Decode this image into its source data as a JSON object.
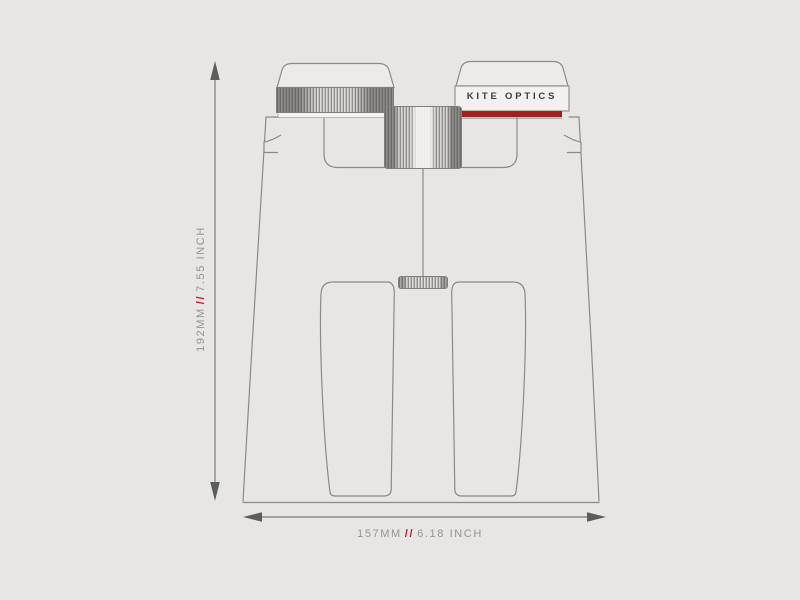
{
  "title": "Binoculars size diagram",
  "brand": {
    "label": "KITE OPTICS"
  },
  "dimensions": {
    "height": {
      "mm": "192MM",
      "separator": "//",
      "inch": "7.55 INCH"
    },
    "width": {
      "mm": "157MM",
      "separator": "//",
      "inch": "6.18 INCH"
    }
  },
  "colors": {
    "background": "#e7e6e4",
    "outline_gray": "#8b8a88",
    "dimension_gray": "#949494",
    "accent_red_band": "#a31e1c",
    "separator_red": "#b0251f",
    "brand_text": "#3d3d3d"
  },
  "icons": [
    "up-arrow-icon",
    "down-arrow-icon",
    "left-arrow-icon",
    "right-arrow-icon"
  ]
}
